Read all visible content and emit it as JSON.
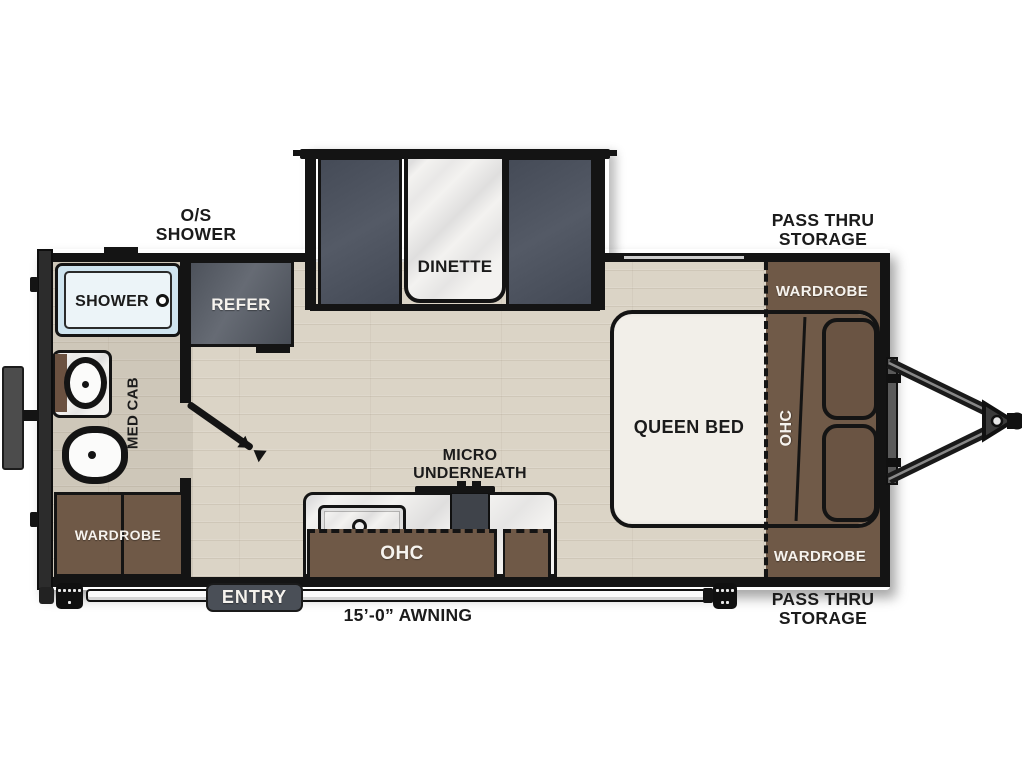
{
  "diagram": {
    "type": "travel-trailer-floorplan",
    "labels": {
      "os_shower": [
        "O/S",
        "SHOWER"
      ],
      "pass_thru": [
        "PASS THRU",
        "STORAGE"
      ],
      "shower": "SHOWER",
      "refer": "REFER",
      "med_cab": "MED CAB",
      "dinette": "DINETTE",
      "queen_bed": "QUEEN BED",
      "ohc": "OHC",
      "wardrobe": "WARDROBE",
      "micro": [
        "MICRO",
        "UNDERNEATH"
      ],
      "entry": "ENTRY",
      "awning": "15’-0” AWNING"
    },
    "colors": {
      "wall_black": "#141414",
      "cabinet_brown": "#6f5947",
      "furniture_gray": "#4b515d",
      "shower_blue": "#cfe4ef",
      "floor_wood": "#dbd4c6",
      "marble": "#f3f2f0",
      "entry_badge": "#4a4f57"
    }
  }
}
